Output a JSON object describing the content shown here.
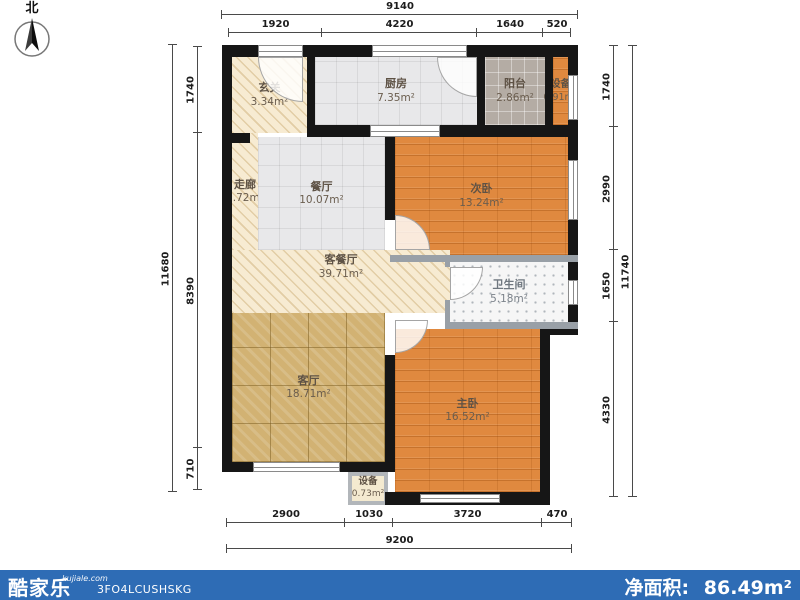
{
  "compass": {
    "label": "北"
  },
  "dims": {
    "top_total": "9140",
    "top_segments": [
      "1920",
      "4220",
      "1640",
      "520"
    ],
    "bottom_segments": [
      "2900",
      "1030",
      "3720",
      "470"
    ],
    "bottom_total": "9200",
    "left_total": "11680",
    "left_segments": [
      "1740",
      "8390",
      "710"
    ],
    "right_segments": [
      "1740",
      "2990",
      "1650",
      "4330"
    ],
    "right_total": "11740"
  },
  "rooms": [
    {
      "name": "玄关",
      "area": "3.34m²"
    },
    {
      "name": "厨房",
      "area": "7.35m²"
    },
    {
      "name": "阳台",
      "area": "2.86m²"
    },
    {
      "name": "设备",
      "area": "0.91m²"
    },
    {
      "name": "走廊",
      "area": "7.72m²"
    },
    {
      "name": "餐厅",
      "area": "10.07m²"
    },
    {
      "name": "次卧",
      "area": "13.24m²"
    },
    {
      "name": "客餐厅",
      "area": "39.71m²"
    },
    {
      "name": "卫生间",
      "area": "5.18m²"
    },
    {
      "name": "客厅",
      "area": "18.71m²"
    },
    {
      "name": "主卧",
      "area": "16.52m²"
    },
    {
      "name": "设备",
      "area": "0.73m²"
    }
  ],
  "footer": {
    "brand": "酷家乐",
    "site": "kujiale.com",
    "code": "3FO4LCUSHSKG",
    "net_area_label": "净面积:",
    "net_area_value": "86.49m²"
  },
  "colors": {
    "wall": "#161616",
    "footer_bar": "#2e6cb5",
    "wood_floor": "#e0893f",
    "marble_floor": "#d2b273",
    "hatch_floor": "#f7ebd2"
  }
}
